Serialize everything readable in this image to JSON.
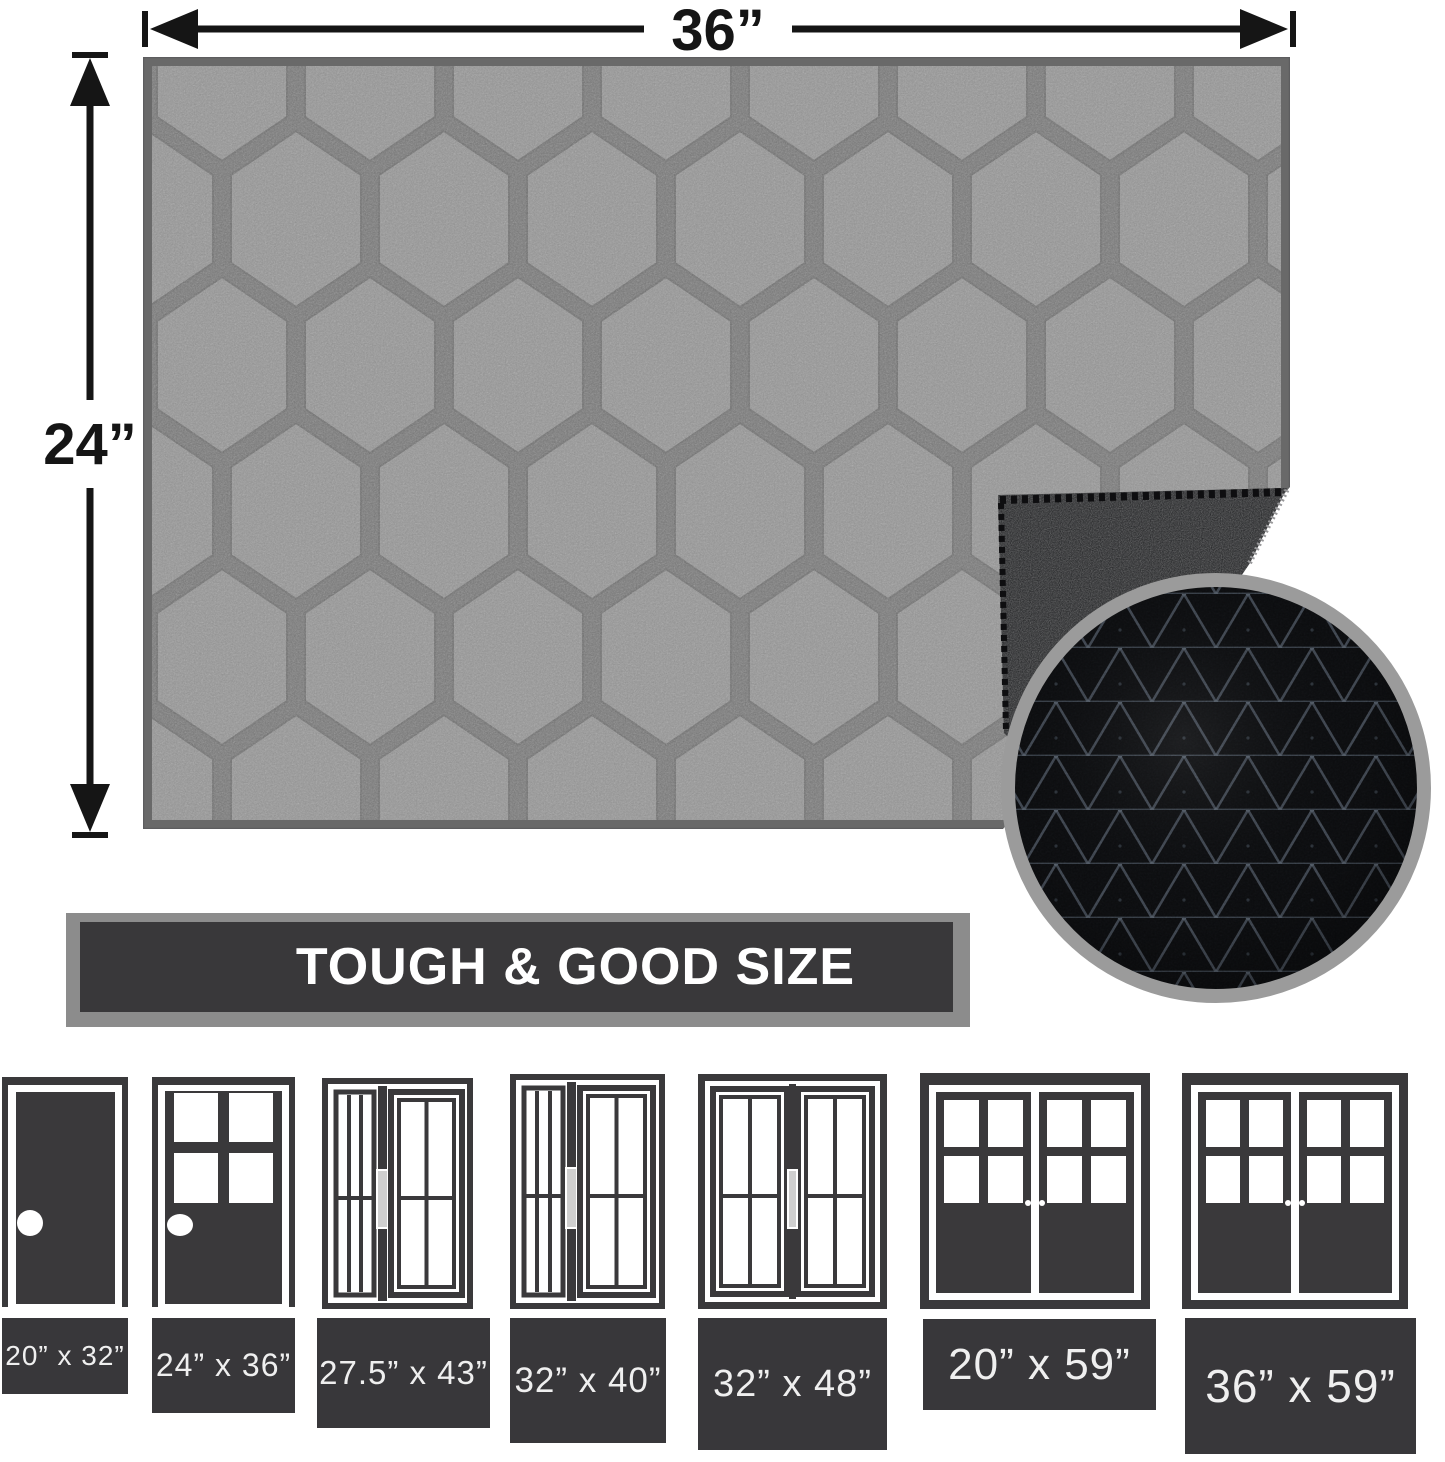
{
  "dimension_labels": {
    "width": "36”",
    "height": "24”"
  },
  "banner": {
    "title": "TOUGH & GOOD SIZE"
  },
  "size_options": [
    {
      "label": "20” x 32”"
    },
    {
      "label": "24” x 36”"
    },
    {
      "label": "27.5” x 43”"
    },
    {
      "label": "32” x 40”"
    },
    {
      "label": "32” x 48”"
    },
    {
      "label": "20” x 59”"
    },
    {
      "label": "36” x 59”"
    }
  ],
  "icons": {
    "door_icons": [
      "single-solid-door-icon",
      "half-glass-door-icon",
      "sliding-door-icon",
      "sliding-door-icon",
      "double-sliding-door-icon",
      "french-double-door-icon",
      "french-double-door-icon"
    ],
    "inset": "rubber-backing-closeup"
  },
  "colors": {
    "accent_dark": "#39383a",
    "rug_gray": "#8b8b8b",
    "backing_black": "#1c1d1f",
    "inset_ring_gray": "#9b9b9b",
    "label_text": "#efefef"
  }
}
